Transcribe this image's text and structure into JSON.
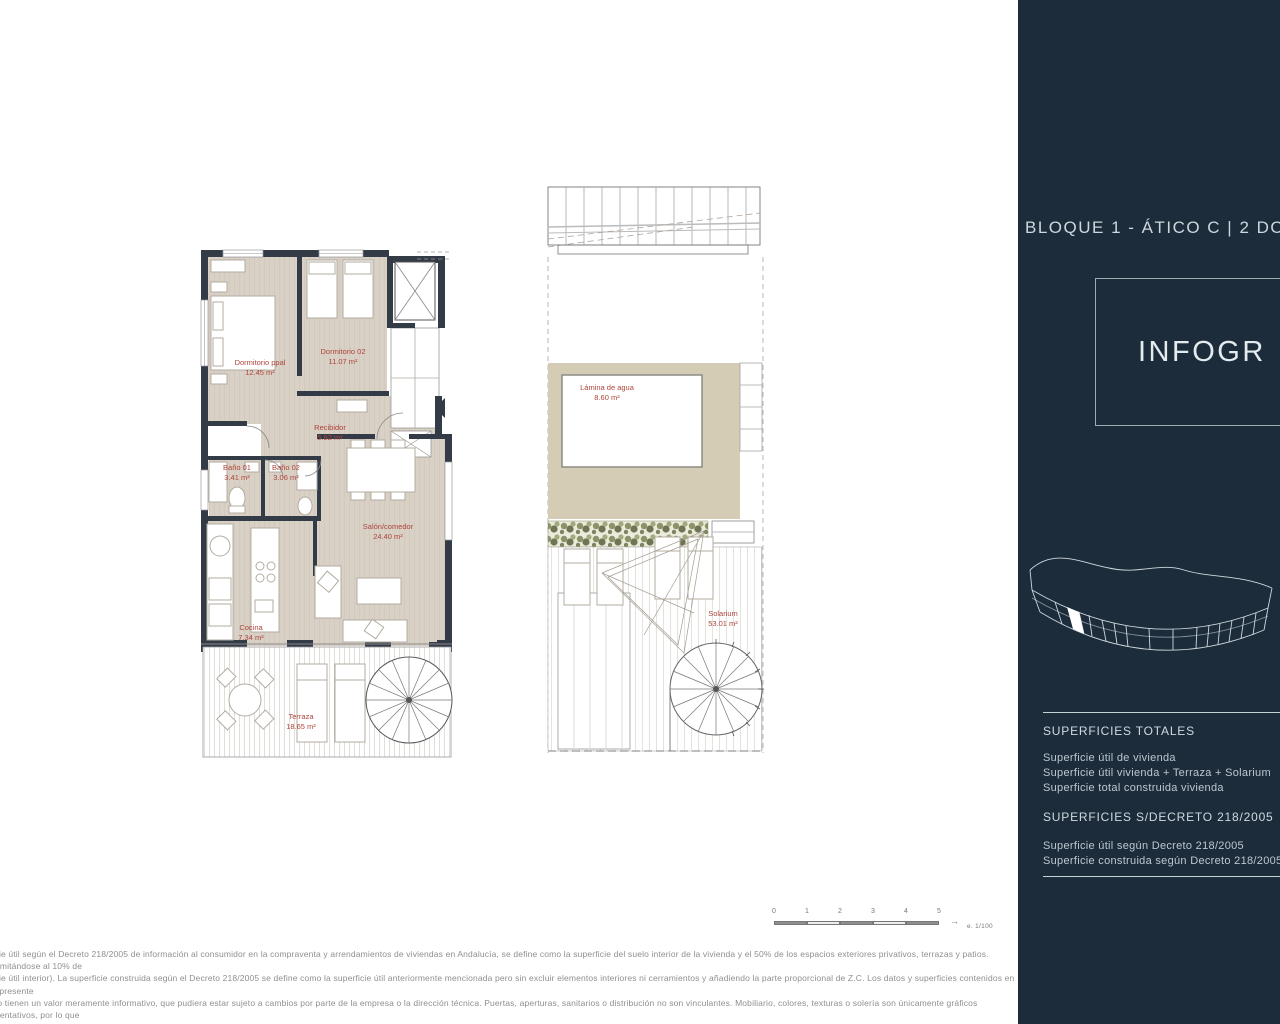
{
  "sidebar": {
    "title": "BLOQUE 1 - ÁTICO C | 2 DORM",
    "infographic_label": "INFOGR",
    "totals_heading": "SUPERFICIES TOTALES",
    "totals_items": [
      "Superficie útil de vivienda",
      "Superficie útil vivienda + Terraza + Solarium",
      "Superficie total construida vivienda"
    ],
    "decree_heading": "SUPERFICIES S/DECRETO 218/2005",
    "decree_items": [
      "Superficie útil según Decreto 218/2005",
      "Superficie construida según Decreto 218/2005"
    ]
  },
  "floor_plan": {
    "rooms": [
      {
        "name": "Dormitorio ppal",
        "area": "12.45 m²"
      },
      {
        "name": "Dormitorio 02",
        "area": "11.07 m²"
      },
      {
        "name": "Recibidor",
        "area": "5.92 m²"
      },
      {
        "name": "Baño 01",
        "area": "3.41 m²"
      },
      {
        "name": "Baño 02",
        "area": "3.06 m²"
      },
      {
        "name": "Salón/comedor",
        "area": "24.40 m²"
      },
      {
        "name": "Cocina",
        "area": "7.34 m²"
      },
      {
        "name": "Terraza",
        "area": "18.65 m²"
      }
    ]
  },
  "roof_plan": {
    "rooms": [
      {
        "name": "Lámina de agua",
        "area": "8.60 m²"
      },
      {
        "name": "Solarium",
        "area": "53.01 m²"
      }
    ]
  },
  "scale_bar": {
    "ticks": [
      "0",
      "1",
      "2",
      "3",
      "4",
      "5"
    ],
    "scale_label": "e. 1/100"
  },
  "disclaimer": {
    "lines": [
      "ficie útil según el Decreto 218/2005 de información al consumidor en la compraventa y arrendamientos de viviendas en Andalucía, se define como la superficie del suelo interior de la vivienda y el 50% de los espacios exteriores privativos, terrazas y patios. (Limitándose al 10% de",
      "ficie útil interior). La superficie construida según el Decreto 218/2005 se define como la superficie útil anteriormente mencionada pero sin excluir elementos interiores ni cerramientos y añadiendo la parte proporcional de Z.C. Los datos y superficies contenidos en el presente",
      "nto tienen un valor meramente informativo, que pudiera estar sujeto a cambios por parte de la empresa o la dirección técnica. Puertas, aperturas, sanitarios o distribución no son vinculantes. Mobiliario, colores, texturas o solería son únicamente gráficos orientativos, por lo que",
      "cumentación no puede ser considerada como una forma de contrato u obligación."
    ]
  },
  "colors": {
    "sidebar_navy": "#1d2c3b",
    "wall_dark": "#333b47",
    "floor_beige": "#d9d0c6",
    "pool_surround_tan": "#d5ccb6",
    "label_red": "#ae443a"
  }
}
